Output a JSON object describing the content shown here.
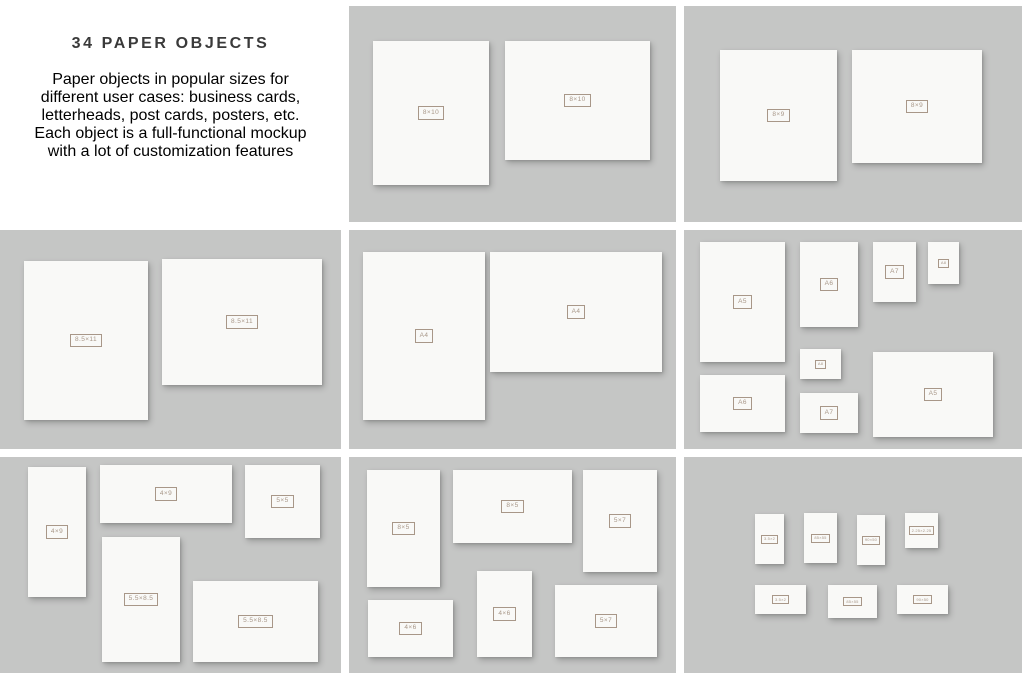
{
  "intro": {
    "title": "34 PAPER OBJECTS",
    "lines": [
      "Paper objects in popular sizes for",
      "different user cases: business cards,",
      "letterheads, post cards, posters, etc.",
      "Each object is a full-functional mockup",
      "with a lot of customization features"
    ]
  },
  "colors": {
    "panel_bg": "#c5c6c5",
    "paper_bg": "#f9f9f7",
    "label_accent": "#a89788",
    "title_color": "#3a3a3a",
    "body_color": "#4c4c4c"
  },
  "panels": [
    {
      "name": "panel-8x10",
      "papers": [
        {
          "label": "8×10",
          "x": 24,
          "y": 35,
          "w": 116,
          "h": 144
        },
        {
          "label": "8×10",
          "x": 156,
          "y": 35,
          "w": 145,
          "h": 119
        }
      ]
    },
    {
      "name": "panel-8x9",
      "papers": [
        {
          "label": "8×9",
          "x": 36,
          "y": 44,
          "w": 117,
          "h": 131
        },
        {
          "label": "8×9",
          "x": 168,
          "y": 44,
          "w": 130,
          "h": 113
        }
      ]
    },
    {
      "name": "panel-8.5x11",
      "papers": [
        {
          "label": "8.5×11",
          "x": 24,
          "y": 31,
          "w": 124,
          "h": 159
        },
        {
          "label": "8.5×11",
          "x": 162,
          "y": 29,
          "w": 160,
          "h": 126
        }
      ]
    },
    {
      "name": "panel-a4",
      "papers": [
        {
          "label": "A4",
          "x": 14,
          "y": 22,
          "w": 122,
          "h": 168
        },
        {
          "label": "A4",
          "x": 141,
          "y": 22,
          "w": 172,
          "h": 120
        }
      ]
    },
    {
      "name": "panel-a5-a8",
      "papers": [
        {
          "label": "A5",
          "x": 16,
          "y": 12,
          "w": 85,
          "h": 120
        },
        {
          "label": "A6",
          "x": 116,
          "y": 12,
          "w": 58,
          "h": 85
        },
        {
          "label": "A7",
          "x": 189,
          "y": 12,
          "w": 43,
          "h": 60
        },
        {
          "label": "A8",
          "x": 244,
          "y": 12,
          "w": 31,
          "h": 42
        },
        {
          "label": "A8",
          "x": 116,
          "y": 119,
          "w": 41,
          "h": 30
        },
        {
          "label": "A6",
          "x": 16,
          "y": 145,
          "w": 85,
          "h": 57
        },
        {
          "label": "A7",
          "x": 116,
          "y": 163,
          "w": 58,
          "h": 40
        },
        {
          "label": "A5",
          "x": 189,
          "y": 122,
          "w": 120,
          "h": 85
        }
      ]
    },
    {
      "name": "panel-4x9-5x5-5.5x8.5",
      "papers": [
        {
          "label": "4×9",
          "x": 28,
          "y": 10,
          "w": 58,
          "h": 130
        },
        {
          "label": "4×9",
          "x": 100,
          "y": 8,
          "w": 132,
          "h": 58
        },
        {
          "label": "5×5",
          "x": 245,
          "y": 8,
          "w": 75,
          "h": 73
        },
        {
          "label": "5.5×8.5",
          "x": 102,
          "y": 80,
          "w": 78,
          "h": 125
        },
        {
          "label": "5.5×8.5",
          "x": 193,
          "y": 124,
          "w": 125,
          "h": 81
        }
      ]
    },
    {
      "name": "panel-8x5-5x7-4x6",
      "papers": [
        {
          "label": "8×5",
          "x": 18,
          "y": 13,
          "w": 73,
          "h": 117
        },
        {
          "label": "8×5",
          "x": 104,
          "y": 13,
          "w": 119,
          "h": 73
        },
        {
          "label": "5×7",
          "x": 234,
          "y": 13,
          "w": 74,
          "h": 102
        },
        {
          "label": "4×6",
          "x": 128,
          "y": 114,
          "w": 55,
          "h": 86
        },
        {
          "label": "4×6",
          "x": 19,
          "y": 143,
          "w": 85,
          "h": 57
        },
        {
          "label": "5×7",
          "x": 206,
          "y": 128,
          "w": 102,
          "h": 72
        }
      ]
    },
    {
      "name": "panel-business-cards",
      "papers": [
        {
          "label": "3.5×2",
          "x": 71,
          "y": 57,
          "w": 29,
          "h": 50
        },
        {
          "label": "85×55",
          "x": 120,
          "y": 56,
          "w": 33,
          "h": 50
        },
        {
          "label": "90×50",
          "x": 173,
          "y": 58,
          "w": 28,
          "h": 50
        },
        {
          "label": "2.25×2.25",
          "x": 221,
          "y": 56,
          "w": 33,
          "h": 35
        },
        {
          "label": "3.5×2",
          "x": 71,
          "y": 128,
          "w": 51,
          "h": 29
        },
        {
          "label": "85×55",
          "x": 144,
          "y": 128,
          "w": 49,
          "h": 33
        },
        {
          "label": "90×50",
          "x": 213,
          "y": 128,
          "w": 51,
          "h": 29
        }
      ]
    }
  ]
}
